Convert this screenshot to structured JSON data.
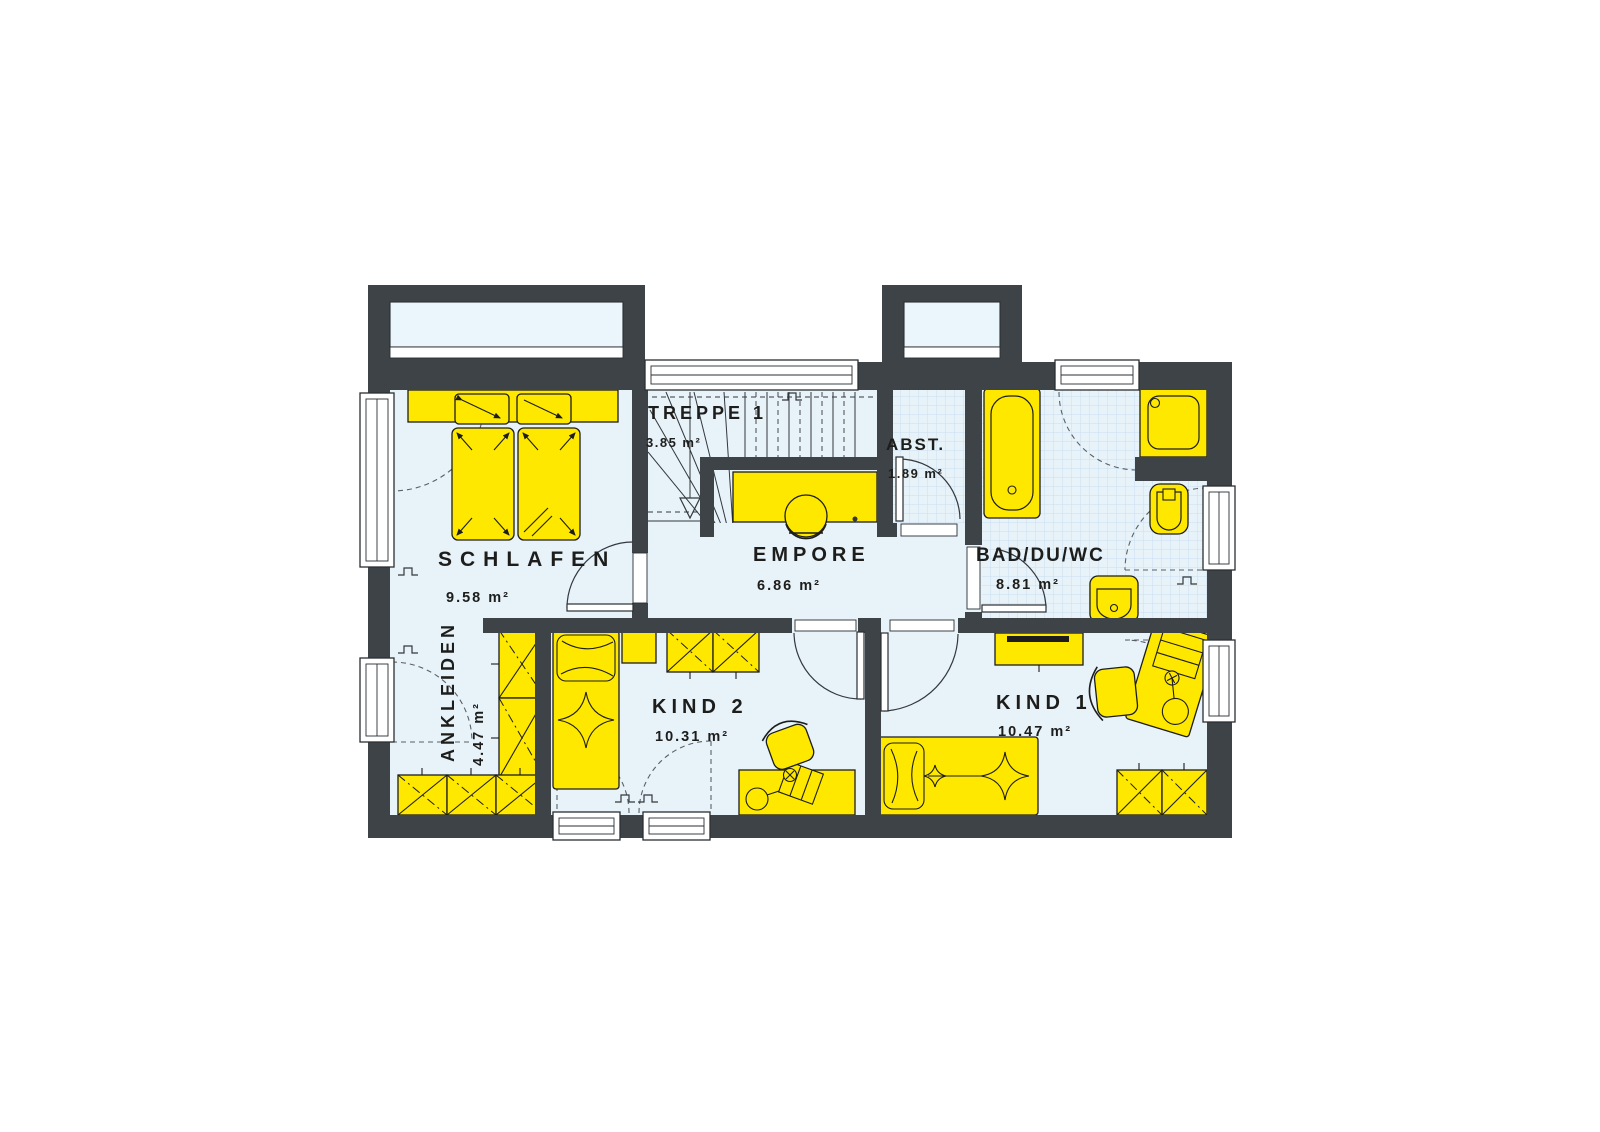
{
  "plan": {
    "title": "Obergeschoss Grundriss",
    "colors": {
      "wall": "#3E4347",
      "floor": "#E7F2F9",
      "tile": "#C9DFEE",
      "furniture": "#FFE800",
      "glass": "#EAF6FC",
      "line": "#1D1D1B"
    },
    "rooms": [
      {
        "id": "schlafen",
        "label": "SCHLAFEN",
        "area": "9.58 m²"
      },
      {
        "id": "treppe1",
        "label": "TREPPE 1",
        "area": "3.85 m²"
      },
      {
        "id": "abst",
        "label": "ABST.",
        "area": "1.89 m²"
      },
      {
        "id": "empore",
        "label": "EMPORE",
        "area": "6.86 m²"
      },
      {
        "id": "bad",
        "label": "BAD/DU/WC",
        "area": "8.81 m²"
      },
      {
        "id": "ankleiden",
        "label": "ANKLEIDEN",
        "area": "4.47 m²"
      },
      {
        "id": "kind2",
        "label": "KIND 2",
        "area": "10.31 m²"
      },
      {
        "id": "kind1",
        "label": "KIND 1",
        "area": "10.47 m²"
      }
    ],
    "fixtures": [
      "double-bed-icon",
      "single-bed-icon",
      "single-bed-icon",
      "wardrobe-icon",
      "wardrobe-icon",
      "wardrobe-icon",
      "desk-icon",
      "desk-icon",
      "desk-icon",
      "chair-icon",
      "chair-icon",
      "chair-icon",
      "bathtub-icon",
      "shower-icon",
      "toilet-icon",
      "sink-icon",
      "stairs-icon"
    ]
  }
}
